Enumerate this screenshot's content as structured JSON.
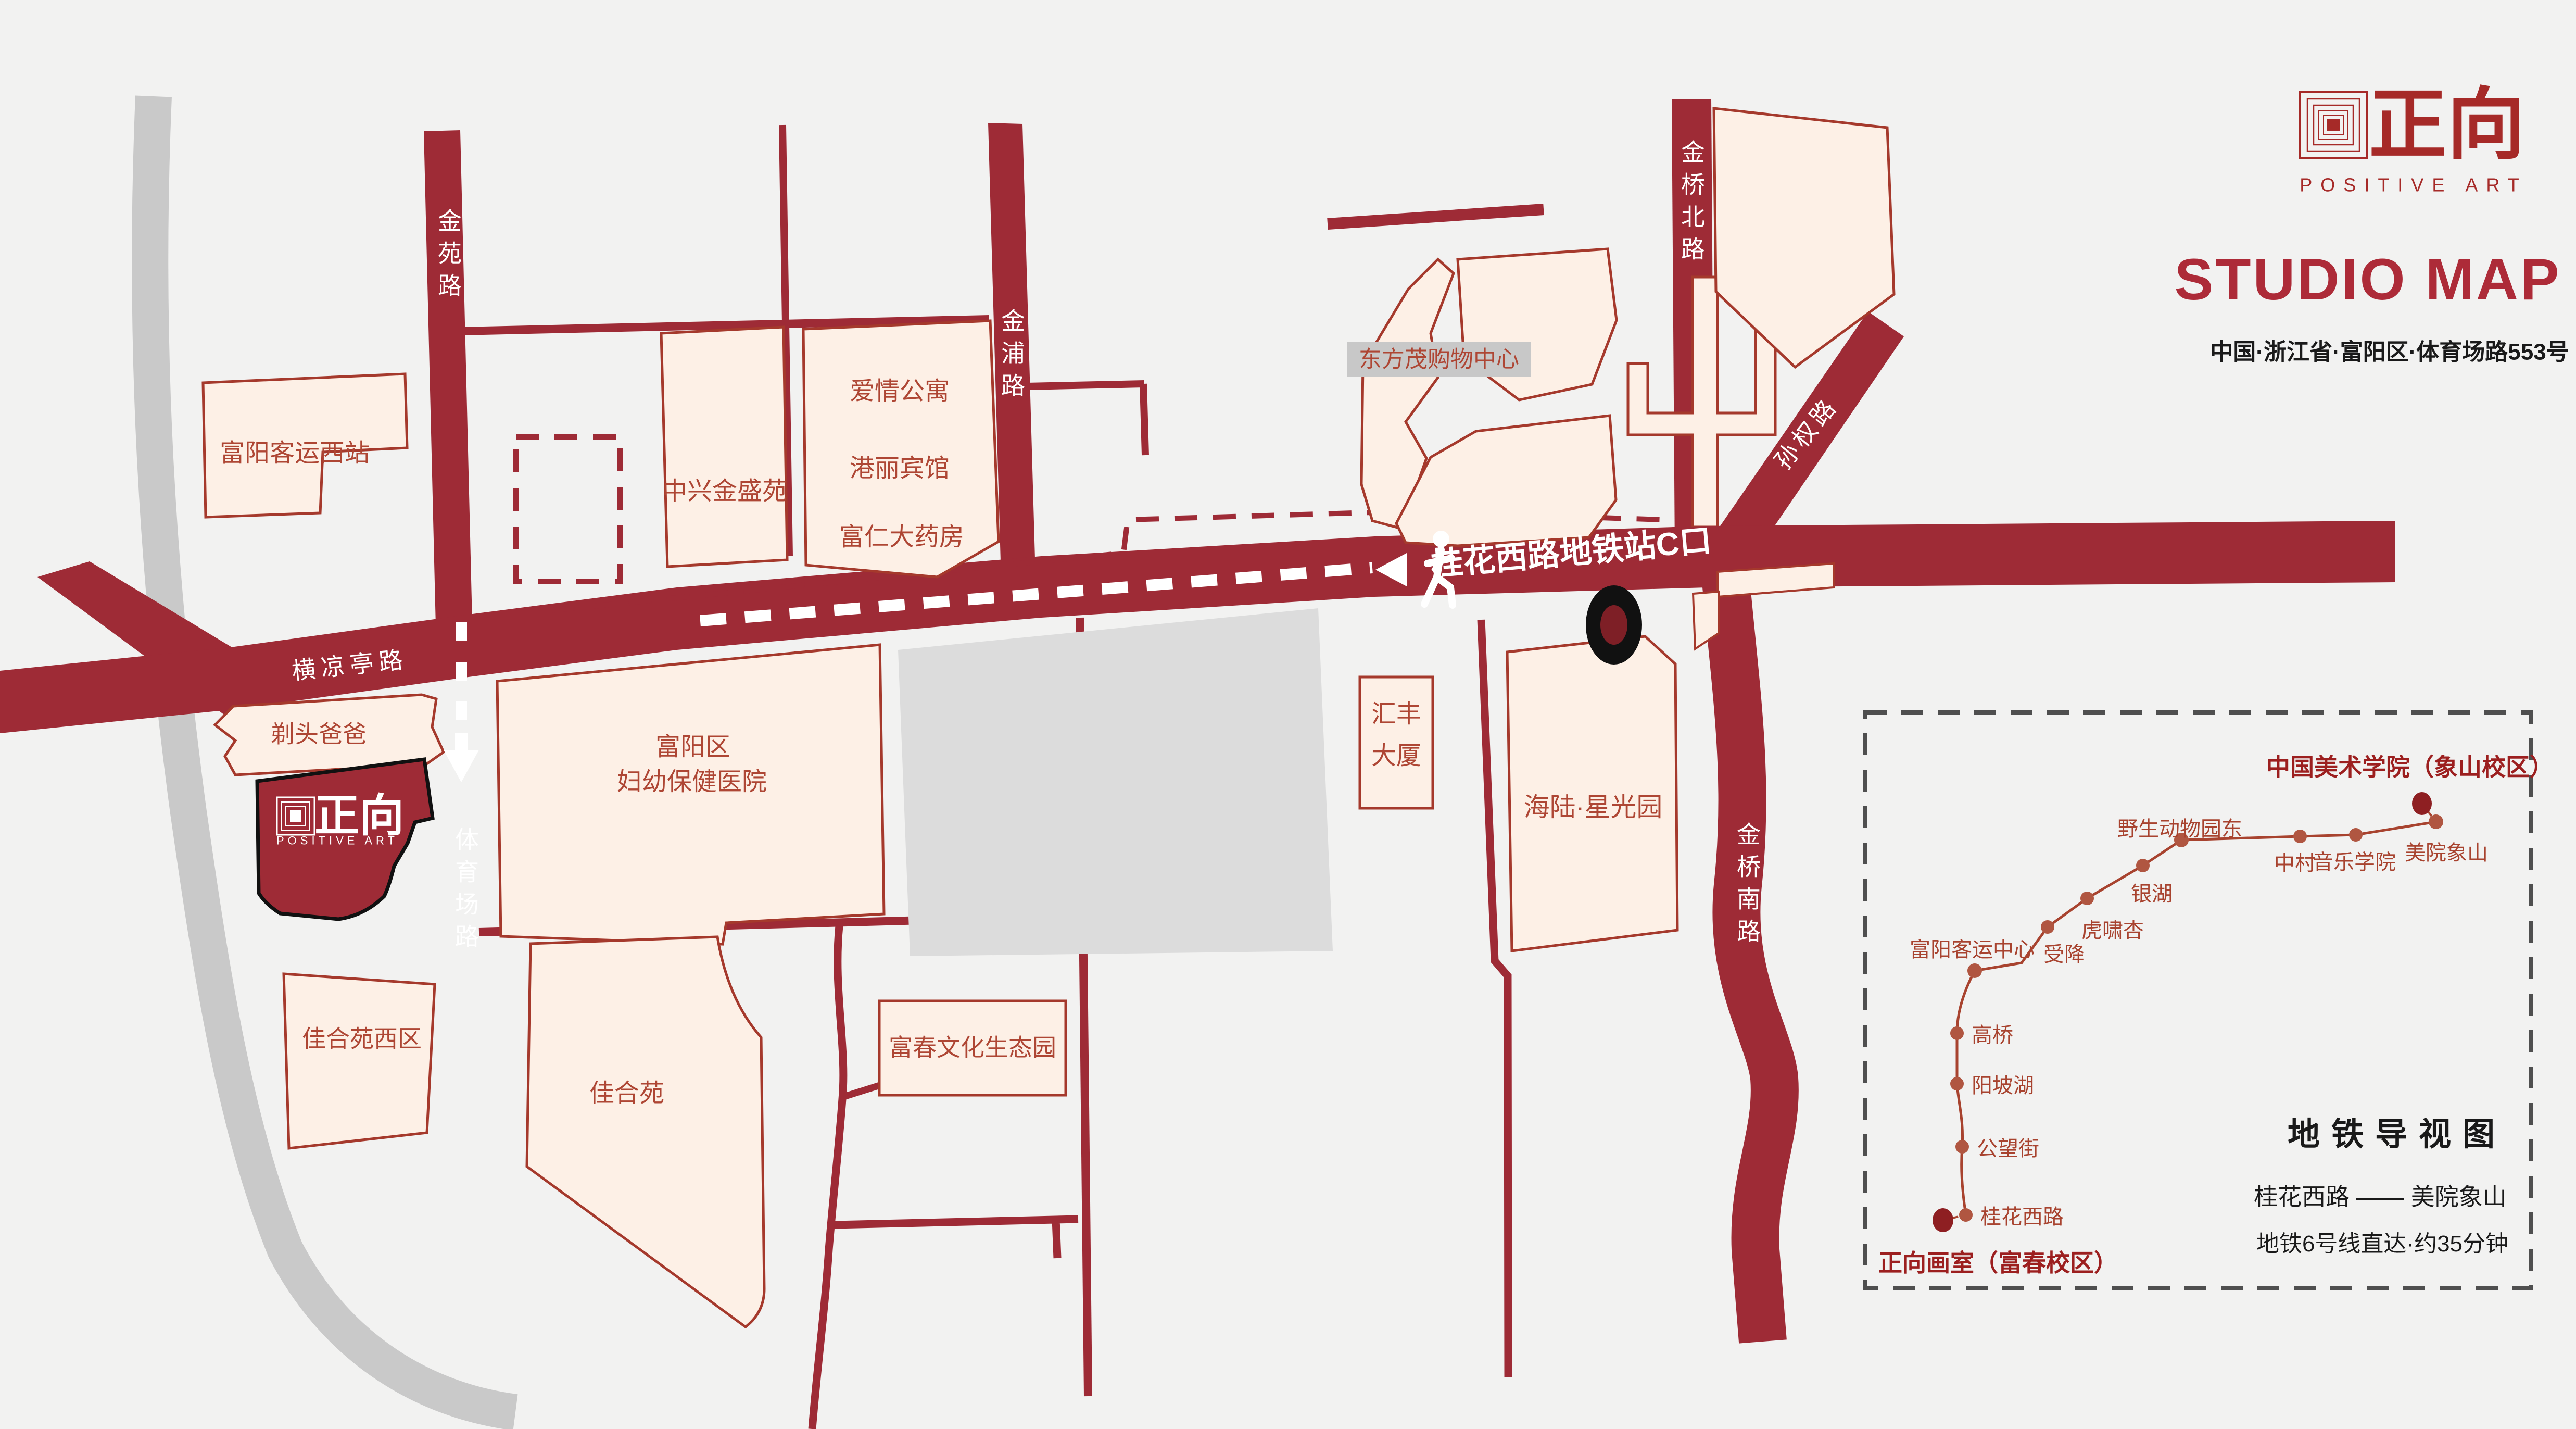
{
  "header": {
    "logo": {
      "zh": "正向",
      "en": "POSITIVE ART"
    },
    "title": "STUDIO MAP",
    "address": "中国·浙江省·富阳区·体育场路553号"
  },
  "map": {
    "roads": {
      "jinyuan_road": "金苑路",
      "jinpu_road": "金浦路",
      "jinqiao_north_road": "金桥北路",
      "sunquan_road": "孙权路",
      "jinqiao_south_road": "金桥南路",
      "tiyuchang_road": "体育场路",
      "hengliangting_road": "横凉亭路"
    },
    "route_label": "桂花西路地铁站C口",
    "buildings": {
      "fuyang_west_bus_station": "富阳客运西站",
      "zhongxing_jinsheng_yuan": "中兴金盛苑",
      "aiqing_block": {
        "line1": "爱情公寓",
        "line2": "港丽宾馆",
        "line3": "富仁大药房"
      },
      "dongfangmao": "东方茂购物中心",
      "titou_baba": "剃头爸爸",
      "studio": {
        "zh": "正向",
        "en": "POSITIVE ART"
      },
      "hospital": {
        "line1": "富阳区",
        "line2": "妇幼保健医院"
      },
      "huifeng": {
        "line1": "汇丰",
        "line2": "大厦"
      },
      "hailu_xingguang": "海陆·星光园",
      "jiaheyuan_west": "佳合苑西区",
      "jiaheyuan": "佳合苑",
      "fuchun_park": "富春文化生态园"
    }
  },
  "inset": {
    "title": "地铁导视图",
    "route": "桂花西路 —— 美院象山",
    "note": "地铁6号线直达·约35分钟",
    "start_label": "正向画室（富春校区）",
    "end_label": "中国美术学院（象山校区）",
    "stations": [
      "桂花西路",
      "公望街",
      "阳坡湖",
      "高桥",
      "富阳客运中心",
      "受降",
      "虎啸杏",
      "银湖",
      "野生动物园东",
      "中村",
      "音乐学院",
      "美院象山"
    ]
  },
  "colors": {
    "road_red": "#9e2b36",
    "building_fill": "#fdf0e6",
    "building_stroke": "#a5392c",
    "label_red": "#ae4634",
    "brand_red": "#a62a28",
    "title_red": "#ad2b38",
    "metro_line_red": "#a8432f",
    "terminal_red": "#8e1f22",
    "marker_black": "#111111",
    "river_gray": "#c9c9c9",
    "inset_border_gray": "#4f4f4f"
  }
}
